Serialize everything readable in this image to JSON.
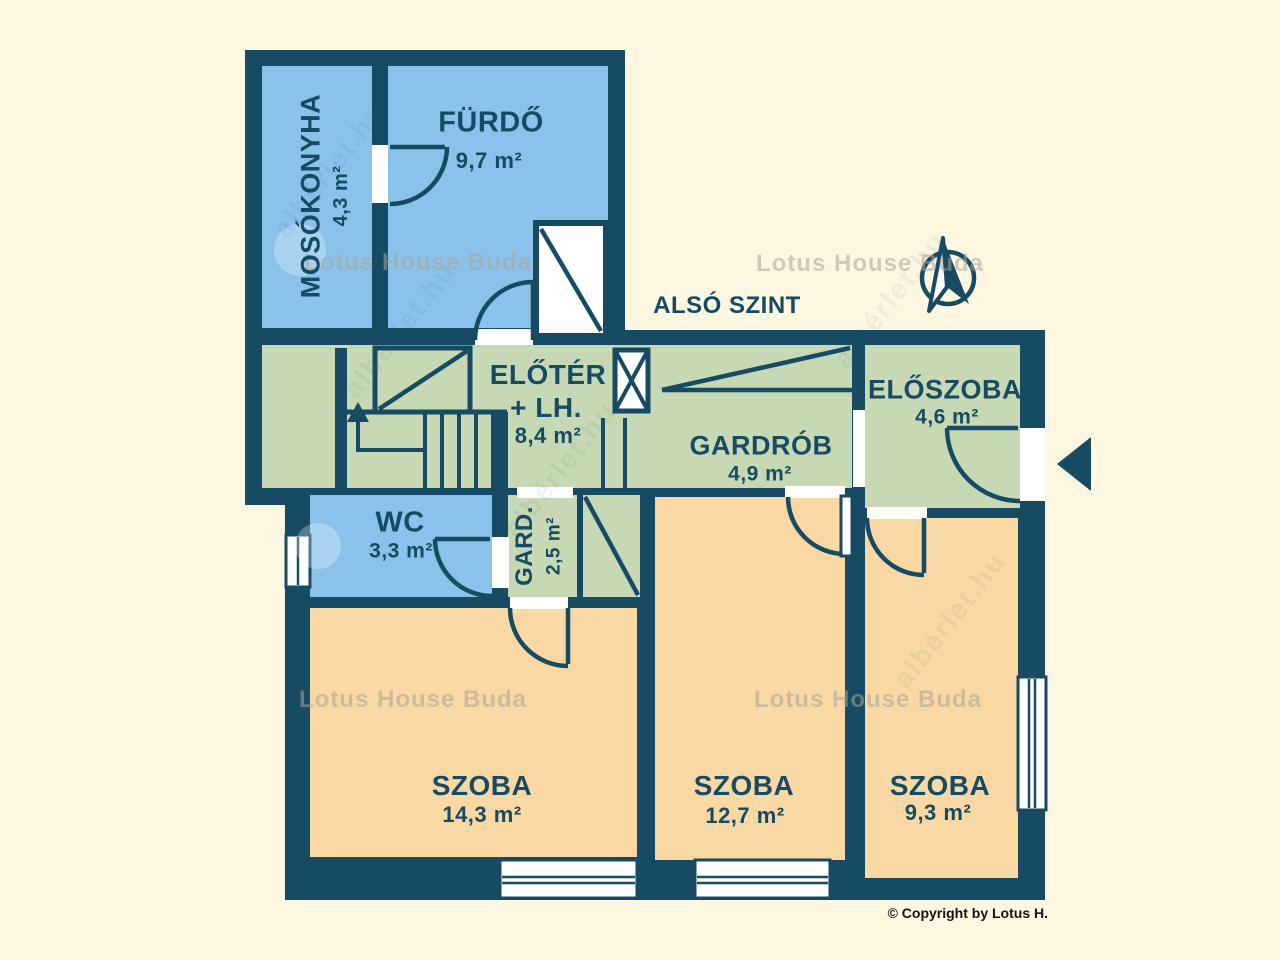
{
  "floor": {
    "title": "ALSÓ SZINT"
  },
  "rooms": {
    "mosokonyha": {
      "name": "MOSÓKONYHA",
      "area": "4,3 m²"
    },
    "furdo": {
      "name": "FÜRDŐ",
      "area": "9,7 m²"
    },
    "eloter": {
      "line1": "ELŐTÉR",
      "line2": "+ LH.",
      "area": "8,4 m²"
    },
    "gardrob": {
      "name": "GARDRÓB",
      "area": "4,9 m²"
    },
    "eloszoba": {
      "name": "ELŐSZOBA",
      "area": "4,6 m²"
    },
    "wc": {
      "name": "WC",
      "area": "3,3 m²"
    },
    "gard": {
      "name": "GARD.",
      "area": "2,5 m²"
    },
    "szoba_nagy": {
      "name": "SZOBA",
      "area": "14,3 m²"
    },
    "szoba_kozepso": {
      "name": "SZOBA",
      "area": "12,7 m²"
    },
    "szoba_kis": {
      "name": "SZOBA",
      "area": "9,3 m²"
    }
  },
  "branding": {
    "watermark": "Lotus House Buda",
    "watermark_diagonal": "albérlet.hu",
    "copyright": "© Copyright by Lotus H."
  },
  "colors": {
    "walls_navy": "#174a63",
    "wet_rooms_blue": "#8ac2ec",
    "circulation_green": "#c6d8b4",
    "bedrooms_orange": "#fad8a4",
    "background_cream": "#fdf6e0",
    "openings_white": "#ffffff"
  },
  "icons": {
    "compass": "north-arrow-icon",
    "entrance": "entrance-arrow-icon"
  }
}
